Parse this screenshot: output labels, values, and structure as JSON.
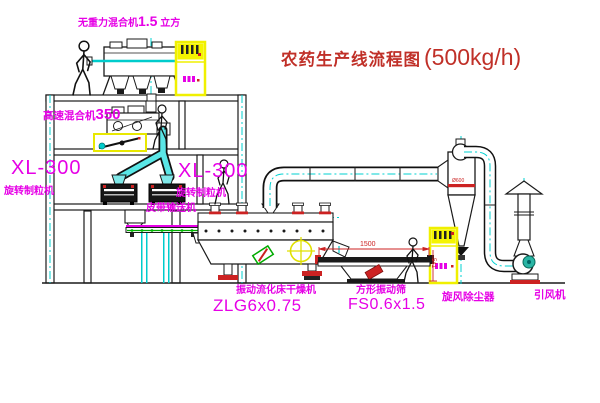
{
  "title": {
    "name": "农药生产线流程图",
    "capacity": "(500kg/h)"
  },
  "equipment": {
    "zero_gravity_mixer": {
      "name": "无重力混合机",
      "spec": "1.5",
      "unit": " 立方"
    },
    "high_speed_mixer": {
      "name": "高速混合机",
      "spec": "350"
    },
    "granulator_left": {
      "model": "XL-300",
      "name": "旋转制粒机"
    },
    "granulator_right": {
      "model": "XL-300",
      "name": "旋转制粒机"
    },
    "belt_conveyor": {
      "name": "皮带输送机"
    },
    "fluid_bed_dryer": {
      "name": "振动流化床干燥机",
      "model": "ZLG6x0.75"
    },
    "vibrating_sieve": {
      "name": "方形振动筛",
      "model": "FS0.6x1.5"
    },
    "cyclone": {
      "name": "旋风除尘器",
      "dia": "Ø600"
    },
    "fan": {
      "name": "引风机"
    }
  },
  "dimensions": {
    "sieve_length": "1500",
    "sieve_height": "541"
  },
  "colors": {
    "line": "#1a1a1a",
    "centerline": "#00d2d2",
    "label": "#e600e6",
    "title": "#c03028",
    "accent_red": "#cc2222",
    "cabinet_yellow": "#f0f000"
  }
}
